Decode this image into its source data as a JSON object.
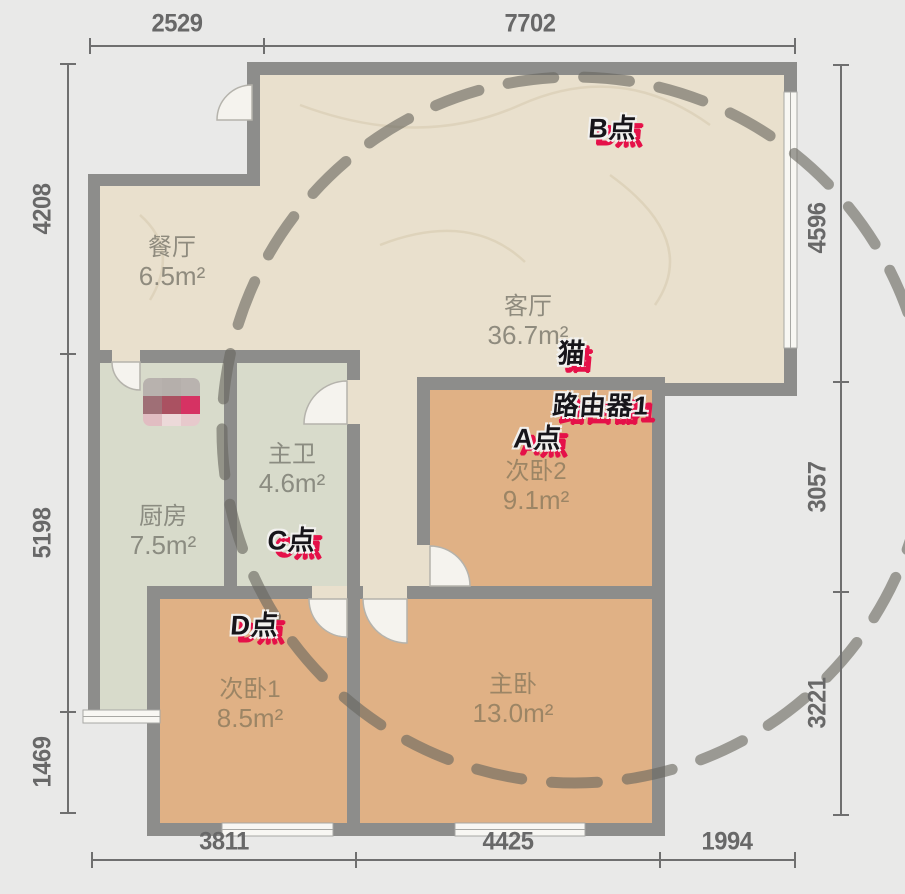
{
  "rooms": [
    {
      "name": "餐厅",
      "area": "6.5m²"
    },
    {
      "name": "客厅",
      "area": "36.7m²"
    },
    {
      "name": "主卫",
      "area": "4.6m²"
    },
    {
      "name": "厨房",
      "area": "7.5m²"
    },
    {
      "name": "次卧2",
      "area": "9.1m²"
    },
    {
      "name": "次卧1",
      "area": "8.5m²"
    },
    {
      "name": "主卧",
      "area": "13.0m²"
    }
  ],
  "markers": [
    {
      "label": "B点"
    },
    {
      "label": "猫"
    },
    {
      "label": "路由器1"
    },
    {
      "label": "A点"
    },
    {
      "label": "C点"
    },
    {
      "label": "D点"
    }
  ],
  "dims": {
    "top": [
      "2529",
      "7702"
    ],
    "bottom": [
      "3811",
      "4425",
      "1994"
    ],
    "left": [
      "4208",
      "5198",
      "1469"
    ],
    "right": [
      "4596",
      "3057",
      "3221"
    ]
  },
  "colors": {
    "background": "#e9e9e8",
    "room_beige": "#e9e0cd",
    "room_green": "#d8dbcb",
    "room_tan": "#e0b185",
    "wall": "#8d8d8b",
    "window_white": "#f8f7f3",
    "door_fan": "#f5f3ee",
    "texture": "#d9cdb2",
    "coverage_dash": "#69675f",
    "badge_red": "#e51149",
    "badge_text": "#17151a",
    "dim_line": "#6f6f6f",
    "dim_text": "#686868"
  },
  "mosaic": {
    "cells": [
      "#b7b0ad",
      "#b4adaa",
      "#b8b1ae",
      "#9d6a72",
      "#a84a5c",
      "#d62a5e",
      "#e2bcc2",
      "#eed9da",
      "#e8c9cd"
    ]
  }
}
